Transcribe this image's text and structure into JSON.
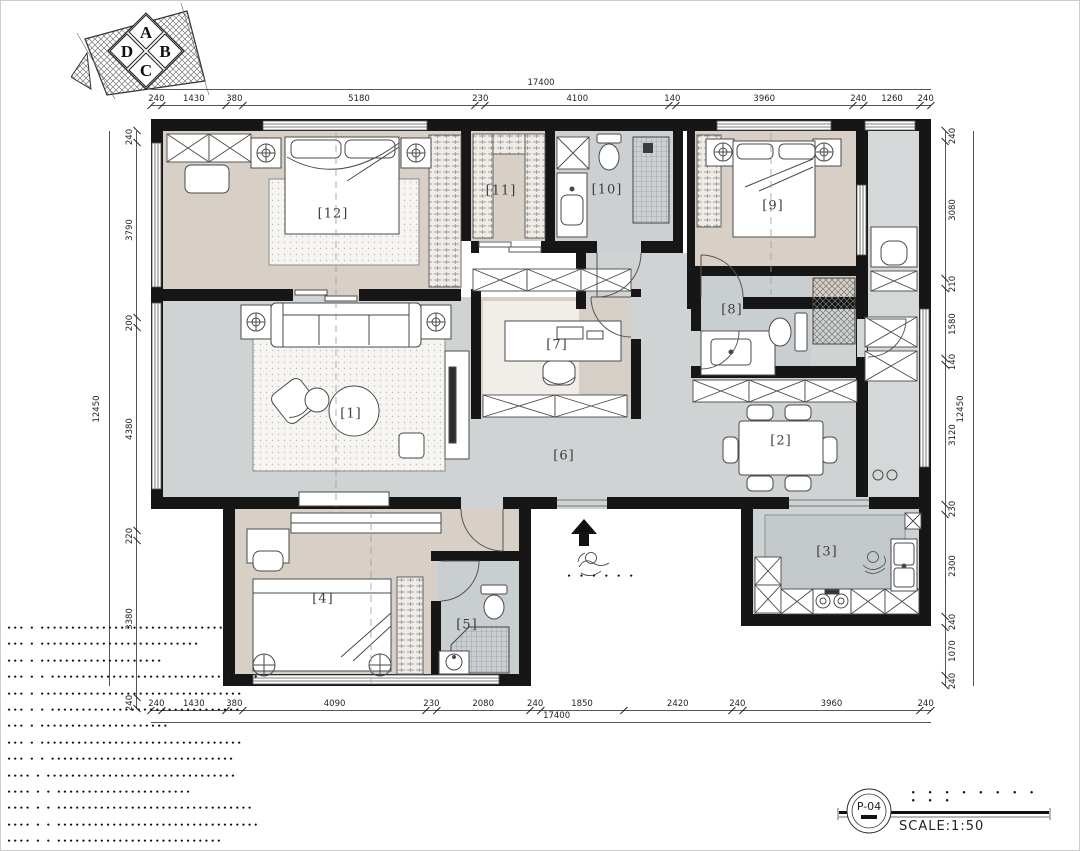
{
  "meta": {
    "sheet_no": "P-04",
    "scale_label": "SCALE:1:50",
    "title_dots": "• • • • • • • • • • •"
  },
  "compass": {
    "letters": [
      "A",
      "B",
      "C",
      "D"
    ]
  },
  "dimensions": {
    "top": {
      "overall": "17400",
      "segments": [
        240,
        1430,
        380,
        5180,
        230,
        4100,
        140,
        3960,
        240,
        1260,
        240
      ]
    },
    "bottom": {
      "overall": "17400",
      "segments": [
        240,
        1430,
        380,
        4090,
        230,
        2080,
        240,
        1850,
        2420,
        240,
        3960,
        240
      ]
    },
    "left": {
      "overall": "12450",
      "segments": [
        240,
        3790,
        200,
        4380,
        220,
        3380,
        240
      ]
    },
    "right": {
      "overall": "12450",
      "segments": [
        240,
        3080,
        210,
        1580,
        140,
        3120,
        230,
        2300,
        240,
        1070,
        240
      ]
    }
  },
  "rooms": {
    "r1": "[1]",
    "r2": "[2]",
    "r3": "[3]",
    "r4": "[4]",
    "r5": "[5]",
    "r6": "[6]",
    "r7": "[7]",
    "r8": "[8]",
    "r9": "[9]",
    "r10": "[10]",
    "r11": "[11]",
    "r12": "[12]"
  },
  "entry": {
    "dots": "• • • • • •"
  },
  "notes": [
    "••• • •••••••••••••••••••••••••••••••",
    "••• • ••••••••••••••••••••••••••",
    "••• • ••••••••••••••••••••",
    "••• • • ••••••••••••••••••••••••••••••••••",
    "••• • •••••••••••••••••••••••••••••••••",
    "••• • • •••••••••••••••••••••••••••••••",
    "••• • •••••••••••••••••••••",
    "••• • •••••••••••••••••••••••••••••••••",
    "••• • • ••••••••••••••••••••••••••••••",
    "•••• • •••••••••••••••••••••••••••••••",
    "•••• • • ••••••••••••••••••••••",
    "•••• • • ••••••••••••••••••••••••••••••••",
    "•••• • • •••••••••••••••••••••••••••••••••",
    "•••• • • •••••••••••••••••••••••••••"
  ]
}
